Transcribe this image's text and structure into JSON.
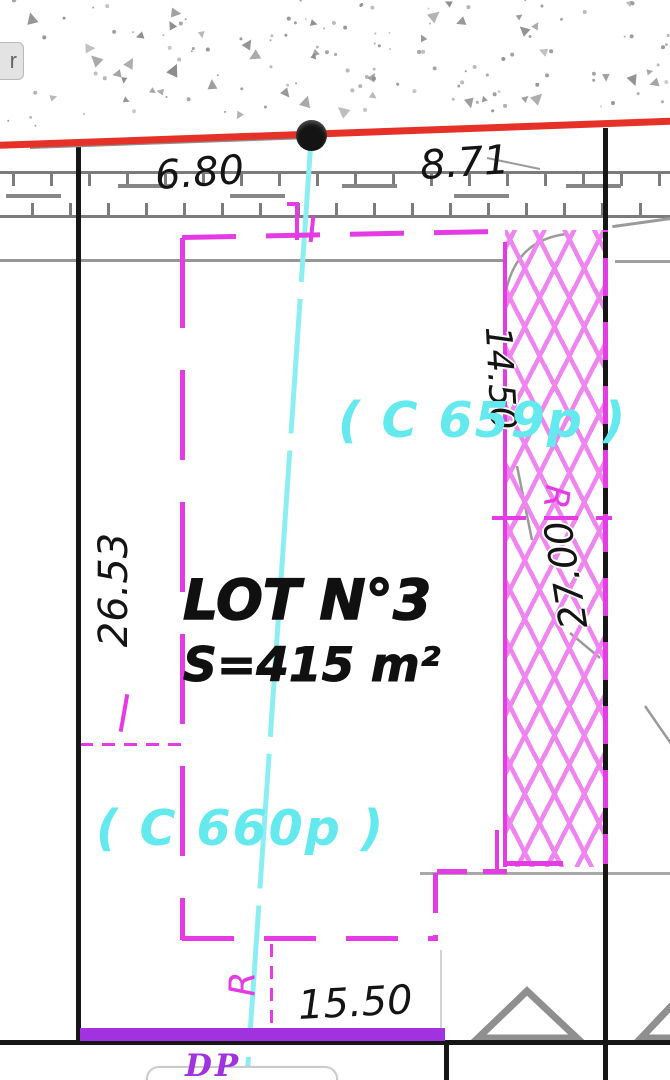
{
  "ui": {
    "edge_button_label": "r"
  },
  "plan": {
    "lot_title": "LOT N°3",
    "lot_area": "S=415 m²",
    "parcel_label_right": "( C 659p )",
    "parcel_label_left": "( C 660p )",
    "public_domain_label": "DP",
    "dimensions": {
      "street_left": "6.80",
      "street_right": "8.71",
      "west_side": "26.53",
      "east_upper": "14.50",
      "east_lower": "27.00",
      "south_side": "15.50"
    },
    "markers": {
      "radius_upper": "R",
      "radius_lower": "R"
    },
    "colors": {
      "boundary_magenta": "#e43be4",
      "hatch_magenta": "#ef86ef",
      "division_cyan": "#8deef2",
      "parcel_text_cyan": "#63e9ee",
      "road_red": "#e53127",
      "dp_purple": "#a032df",
      "line_black": "#161616",
      "contour_gray": "#979797"
    }
  }
}
